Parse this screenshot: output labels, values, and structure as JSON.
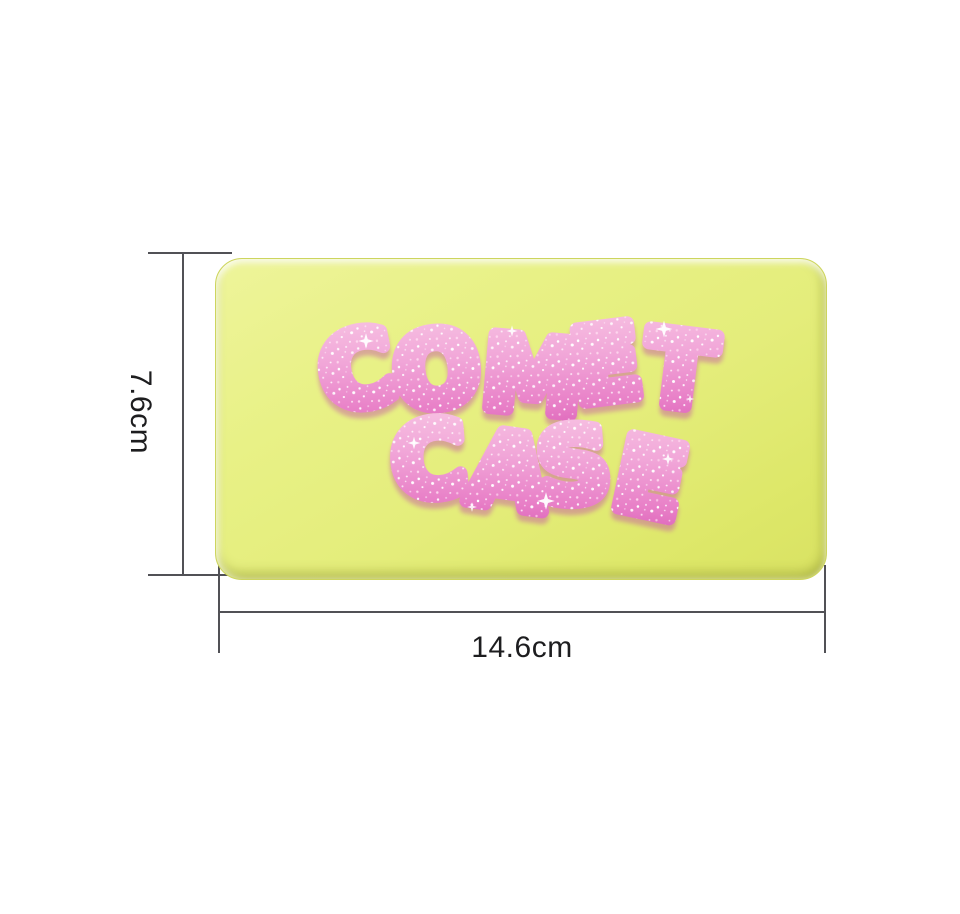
{
  "figure": {
    "background_color": "#ffffff",
    "description": "product size diagram of a rectangular cosmetic case"
  },
  "product_case": {
    "label_line1": "COMET",
    "label_line2": "CASE",
    "body_color": "#e4ed7b",
    "edge_color": "#cdd55e",
    "lettering_pink_light": "#f8c6e4",
    "lettering_pink_deep": "#d95cb5",
    "glitter_color": "#ffffff"
  },
  "dimensions": {
    "height_label": "7.6cm",
    "width_label": "14.6cm",
    "line_color": "#515156",
    "label_color": "#1d1d1f"
  }
}
